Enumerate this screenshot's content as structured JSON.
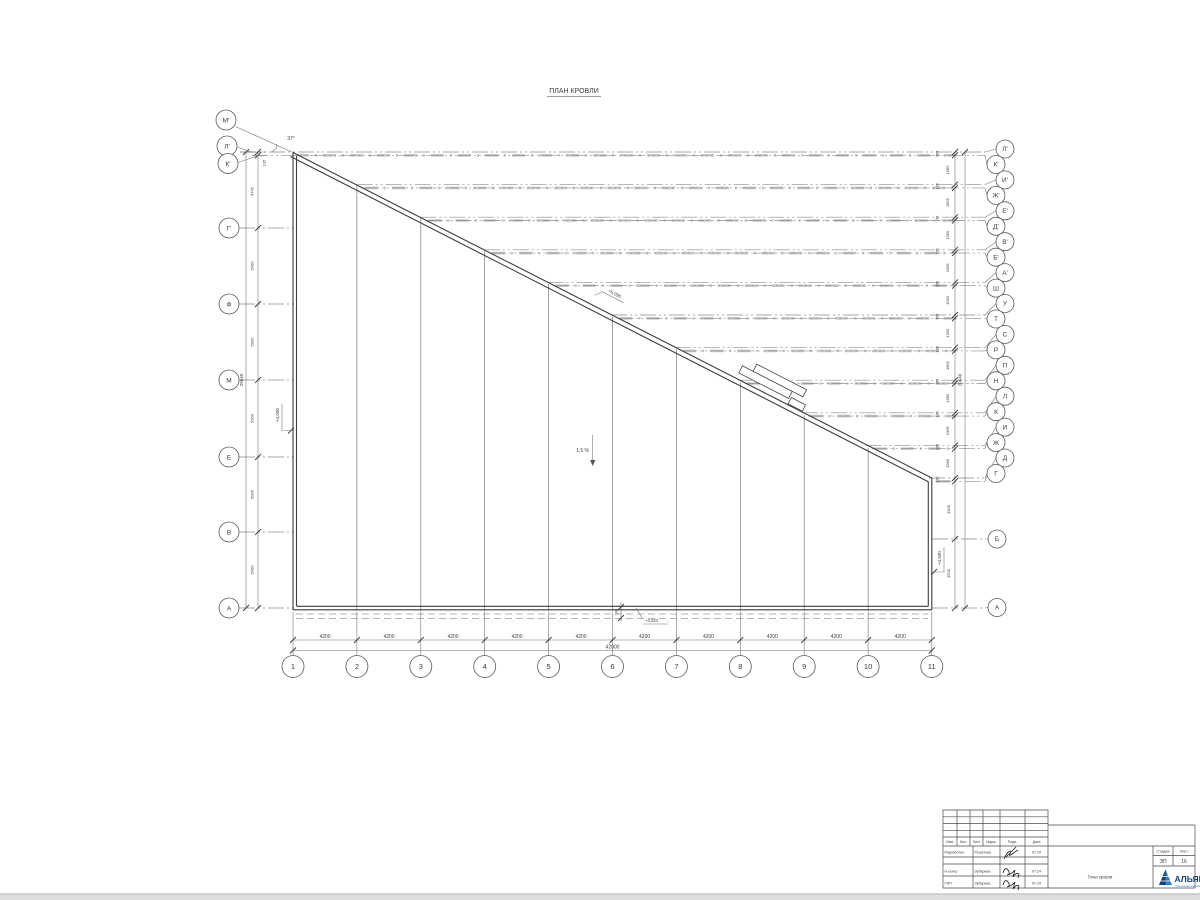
{
  "page": {
    "title": "ПЛАН КРОВЛИ"
  },
  "annotations": {
    "angle": "37°",
    "slope": "1,5 %",
    "elev_left": "+4,500",
    "elev_diagonal": "+5,090",
    "elev_right": "+4,590",
    "elev_bottom": "+4,334",
    "dim_100": "100"
  },
  "axes": {
    "left": [
      "М'",
      "Л'",
      "К'",
      "Г'",
      "Ф",
      "М",
      "Е",
      "В",
      "А"
    ],
    "right": [
      "Л'",
      "К'",
      "И'",
      "Ж'",
      "Е'",
      "Д'",
      "В'",
      "Б'",
      "А'",
      "Ш",
      "У",
      "Т",
      "С",
      "Р",
      "П",
      "Н",
      "Л",
      "К",
      "И",
      "Ж",
      "Д",
      "Г",
      "Б",
      "А"
    ],
    "bottom": [
      "1",
      "2",
      "3",
      "4",
      "5",
      "6",
      "7",
      "8",
      "9",
      "10",
      "11"
    ]
  },
  "dims": {
    "left_chain": [
      "195",
      "4745",
      "5000",
      "5000",
      "5000",
      "5000",
      "5000"
    ],
    "left_total": "29640",
    "right_small": "195",
    "right_big": "1965",
    "right_total": "29640",
    "right_lower": [
      "4305",
      "4500"
    ],
    "bottom_step": "4200",
    "bottom_total": "42000"
  },
  "titleblock": {
    "rev_headers": [
      "Изм.",
      "Кол.",
      "Лист",
      "№док.",
      "Подп.",
      "Дата"
    ],
    "sig_rows": [
      {
        "role": "Разработал",
        "name": "Решетова",
        "date": "07.24"
      },
      {
        "role": "Н.контр",
        "name": "Зубарева",
        "date": "07.24"
      },
      {
        "role": "ГИП",
        "name": "Зубарева",
        "date": "07.24"
      }
    ],
    "stage_label": "Стадия",
    "sheet_label": "Лист",
    "stage_value": "ЭП",
    "sheet_value": "16",
    "doc_title": "План кровли",
    "company_name": "АЛЬЯНС",
    "company_tagline": "строительная компания"
  }
}
